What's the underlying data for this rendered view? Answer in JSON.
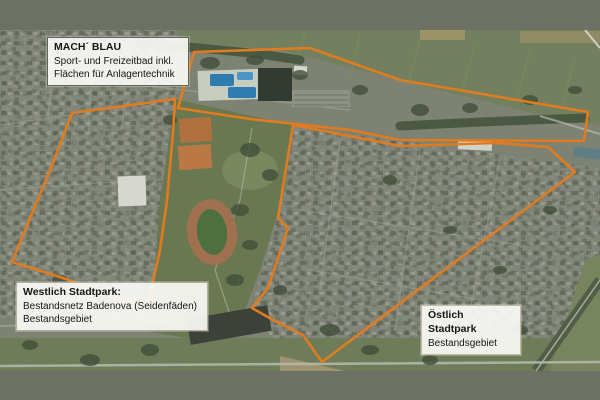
{
  "frame": {
    "letterbox_color": "#6d7164"
  },
  "map": {
    "description": "aerial-photo of Stadtpark area with marked districts",
    "outline_color": "#E07C1F",
    "outline_width": 2.6,
    "labels": {
      "machblau": {
        "title": "MACH´ BLAU",
        "line1": "Sport- und Freizeitbad inkl.",
        "line2": "Flächen für Anlagentechnik"
      },
      "westlich": {
        "title": "Westlich Stadtpark:",
        "line1": "Bestandsnetz Badenova (Seidenfäden)",
        "line2": "Bestandsgebiet"
      },
      "oestlich": {
        "title": "Östlich Stadtpark",
        "line1": "Bestandsgebiet"
      }
    },
    "areas": [
      {
        "name": "area-outline-machblau-freizeitbad",
        "points": [
          [
            194,
            22
          ],
          [
            310,
            18
          ],
          [
            400,
            50
          ],
          [
            588,
            82
          ],
          [
            584,
            111
          ],
          [
            400,
            110
          ],
          [
            350,
            100
          ],
          [
            250,
            89
          ],
          [
            178,
            78
          ]
        ]
      },
      {
        "name": "area-outline-westlich-stadtpark",
        "points": [
          [
            72,
            83
          ],
          [
            175,
            69
          ],
          [
            173,
            103
          ],
          [
            167,
            170
          ],
          [
            160,
            220
          ],
          [
            153,
            252
          ],
          [
            148,
            278
          ],
          [
            60,
            247
          ],
          [
            12,
            232
          ],
          [
            53,
            133
          ]
        ]
      },
      {
        "name": "area-outline-oestlich-stadtpark",
        "points": [
          [
            293,
            95
          ],
          [
            400,
            116
          ],
          [
            497,
            113
          ],
          [
            548,
            117
          ],
          [
            575,
            142
          ],
          [
            322,
            332
          ],
          [
            303,
            305
          ],
          [
            273,
            290
          ],
          [
            252,
            278
          ],
          [
            268,
            258
          ],
          [
            288,
            198
          ],
          [
            278,
            188
          ]
        ]
      }
    ]
  }
}
